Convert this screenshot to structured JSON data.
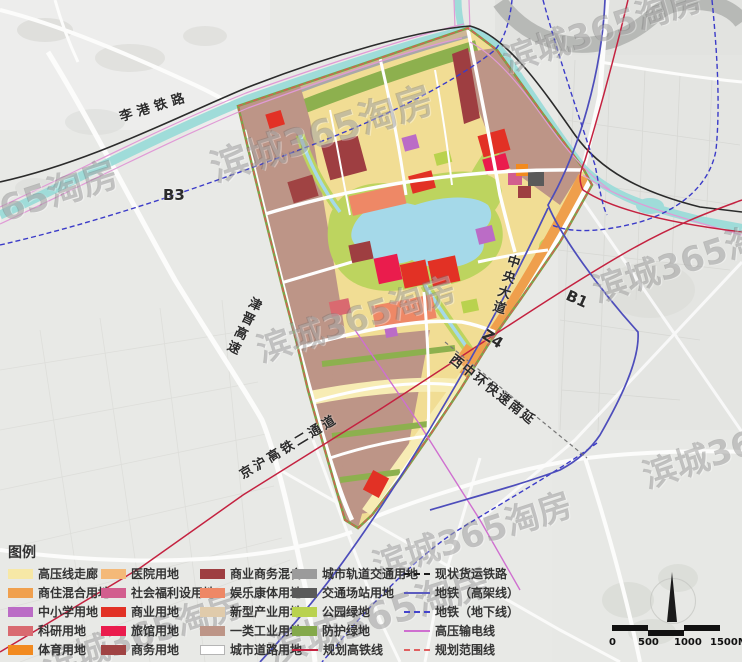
{
  "labels": {
    "ligang": "李港铁路",
    "b3": "B3",
    "jinjin": "津晋高速",
    "jinghu": "京沪高铁二通道",
    "central": "中央大道",
    "z4": "Z4",
    "xizhonghuan": "西中环快速南延",
    "b1": "B1"
  },
  "watermark": {
    "text": "滨城365淘房"
  },
  "legend": {
    "title": "图例",
    "columns": [
      {
        "items": [
          {
            "label": "高压线走廊",
            "type": "swatch",
            "color": "#f7e8a6"
          },
          {
            "label": "商住混合用地",
            "type": "swatch",
            "color": "#f0a04e"
          },
          {
            "label": "中小学用地",
            "type": "swatch",
            "color": "#bb6cc6"
          },
          {
            "label": "科研用地",
            "type": "swatch",
            "color": "#d96a70"
          },
          {
            "label": "体育用地",
            "type": "swatch",
            "color": "#f28a1f"
          }
        ]
      },
      {
        "items": [
          {
            "label": "医院用地",
            "type": "swatch",
            "color": "#f4b978"
          },
          {
            "label": "社会福利设用地",
            "type": "swatch",
            "color": "#d25e8e"
          },
          {
            "label": "商业用地",
            "type": "swatch",
            "color": "#e23125"
          },
          {
            "label": "旅馆用地",
            "type": "swatch",
            "color": "#ea1c4d"
          },
          {
            "label": "商务用地",
            "type": "swatch",
            "color": "#a04343"
          }
        ]
      },
      {
        "items": [
          {
            "label": "商业商务混合",
            "type": "swatch",
            "color": "#9e3e41"
          },
          {
            "label": "娱乐康体用地",
            "type": "swatch",
            "color": "#ee8866"
          },
          {
            "label": "新型产业用地",
            "type": "swatch",
            "color": "#e0cbab"
          },
          {
            "label": "一类工业用地",
            "type": "swatch",
            "color": "#bd9587"
          },
          {
            "label": "城市道路用地",
            "type": "swatch",
            "color": "#ffffff"
          }
        ]
      },
      {
        "items": [
          {
            "label": "城市轨道交通用地",
            "type": "swatch",
            "color": "#9b9b9b"
          },
          {
            "label": "交通场站用地",
            "type": "swatch",
            "color": "#5a5a5a"
          },
          {
            "label": "公园绿地",
            "type": "swatch",
            "color": "#b9d24e"
          },
          {
            "label": "防护绿地",
            "type": "swatch",
            "color": "#84a94a"
          },
          {
            "label": "规划高铁线",
            "type": "line",
            "line_style": "solid",
            "color": "#c42240"
          }
        ]
      },
      {
        "items": [
          {
            "label": "现状货运铁路",
            "type": "line",
            "line_style": "dashed",
            "color": "#1a1a1a"
          },
          {
            "label": "地铁（高架线）",
            "type": "line",
            "line_style": "solid",
            "color": "#5b5bbf"
          },
          {
            "label": "地铁（地下线）",
            "type": "line",
            "line_style": "dashed",
            "color": "#4444cc"
          },
          {
            "label": "高压输电线",
            "type": "line",
            "line_style": "solid",
            "color": "#cf6fd0"
          },
          {
            "label": "规划范围线",
            "type": "line",
            "line_style": "dashed",
            "color": "#e06060"
          }
        ]
      }
    ]
  },
  "scale_bar": {
    "ticks": [
      "0",
      "500",
      "1000",
      "1500M"
    ]
  },
  "colors": {
    "canal": "#9fdcd9",
    "lake": "#a5d9e9",
    "park_green": "#bdd45f",
    "protect_green": "#8db04e",
    "parcel_yellow": "#f1dd94",
    "industry_mauve": "#bd9587",
    "metro_blue": "#4d4dbb",
    "hsr_red": "#c42240",
    "power_magenta": "#cf6fd0",
    "boundary_red": "#e05555"
  }
}
